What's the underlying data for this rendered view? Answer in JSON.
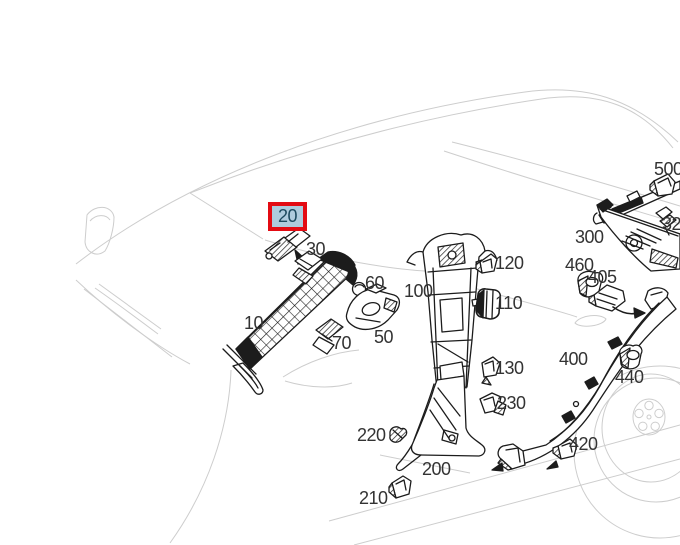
{
  "diagram": {
    "type": "parts-catalog-exploded-view",
    "background": "#ffffff",
    "label_color": "#333333",
    "highlight_colors": {
      "border": "#e30b13",
      "fill": "#aecbdd",
      "text": "#1d4a5f"
    },
    "labels": [
      {
        "text": "20",
        "highlighted": true
      },
      {
        "text": "30",
        "highlighted": false
      },
      {
        "text": "10",
        "highlighted": false
      },
      {
        "text": "60",
        "highlighted": false
      },
      {
        "text": "50",
        "highlighted": false
      },
      {
        "text": "70",
        "highlighted": false
      },
      {
        "text": "100",
        "highlighted": false
      },
      {
        "text": "120",
        "highlighted": false
      },
      {
        "text": "110",
        "highlighted": false
      },
      {
        "text": "130",
        "highlighted": false
      },
      {
        "text": "230",
        "highlighted": false
      },
      {
        "text": "220",
        "highlighted": false
      },
      {
        "text": "200",
        "highlighted": false
      },
      {
        "text": "210",
        "highlighted": false
      },
      {
        "text": "300",
        "highlighted": false
      },
      {
        "text": "460",
        "highlighted": false
      },
      {
        "text": "405",
        "highlighted": false
      },
      {
        "text": "500",
        "highlighted": false
      },
      {
        "text": "320",
        "highlighted": false
      },
      {
        "text": "400",
        "highlighted": false
      },
      {
        "text": "440",
        "highlighted": false
      },
      {
        "text": "420",
        "highlighted": false
      }
    ]
  }
}
